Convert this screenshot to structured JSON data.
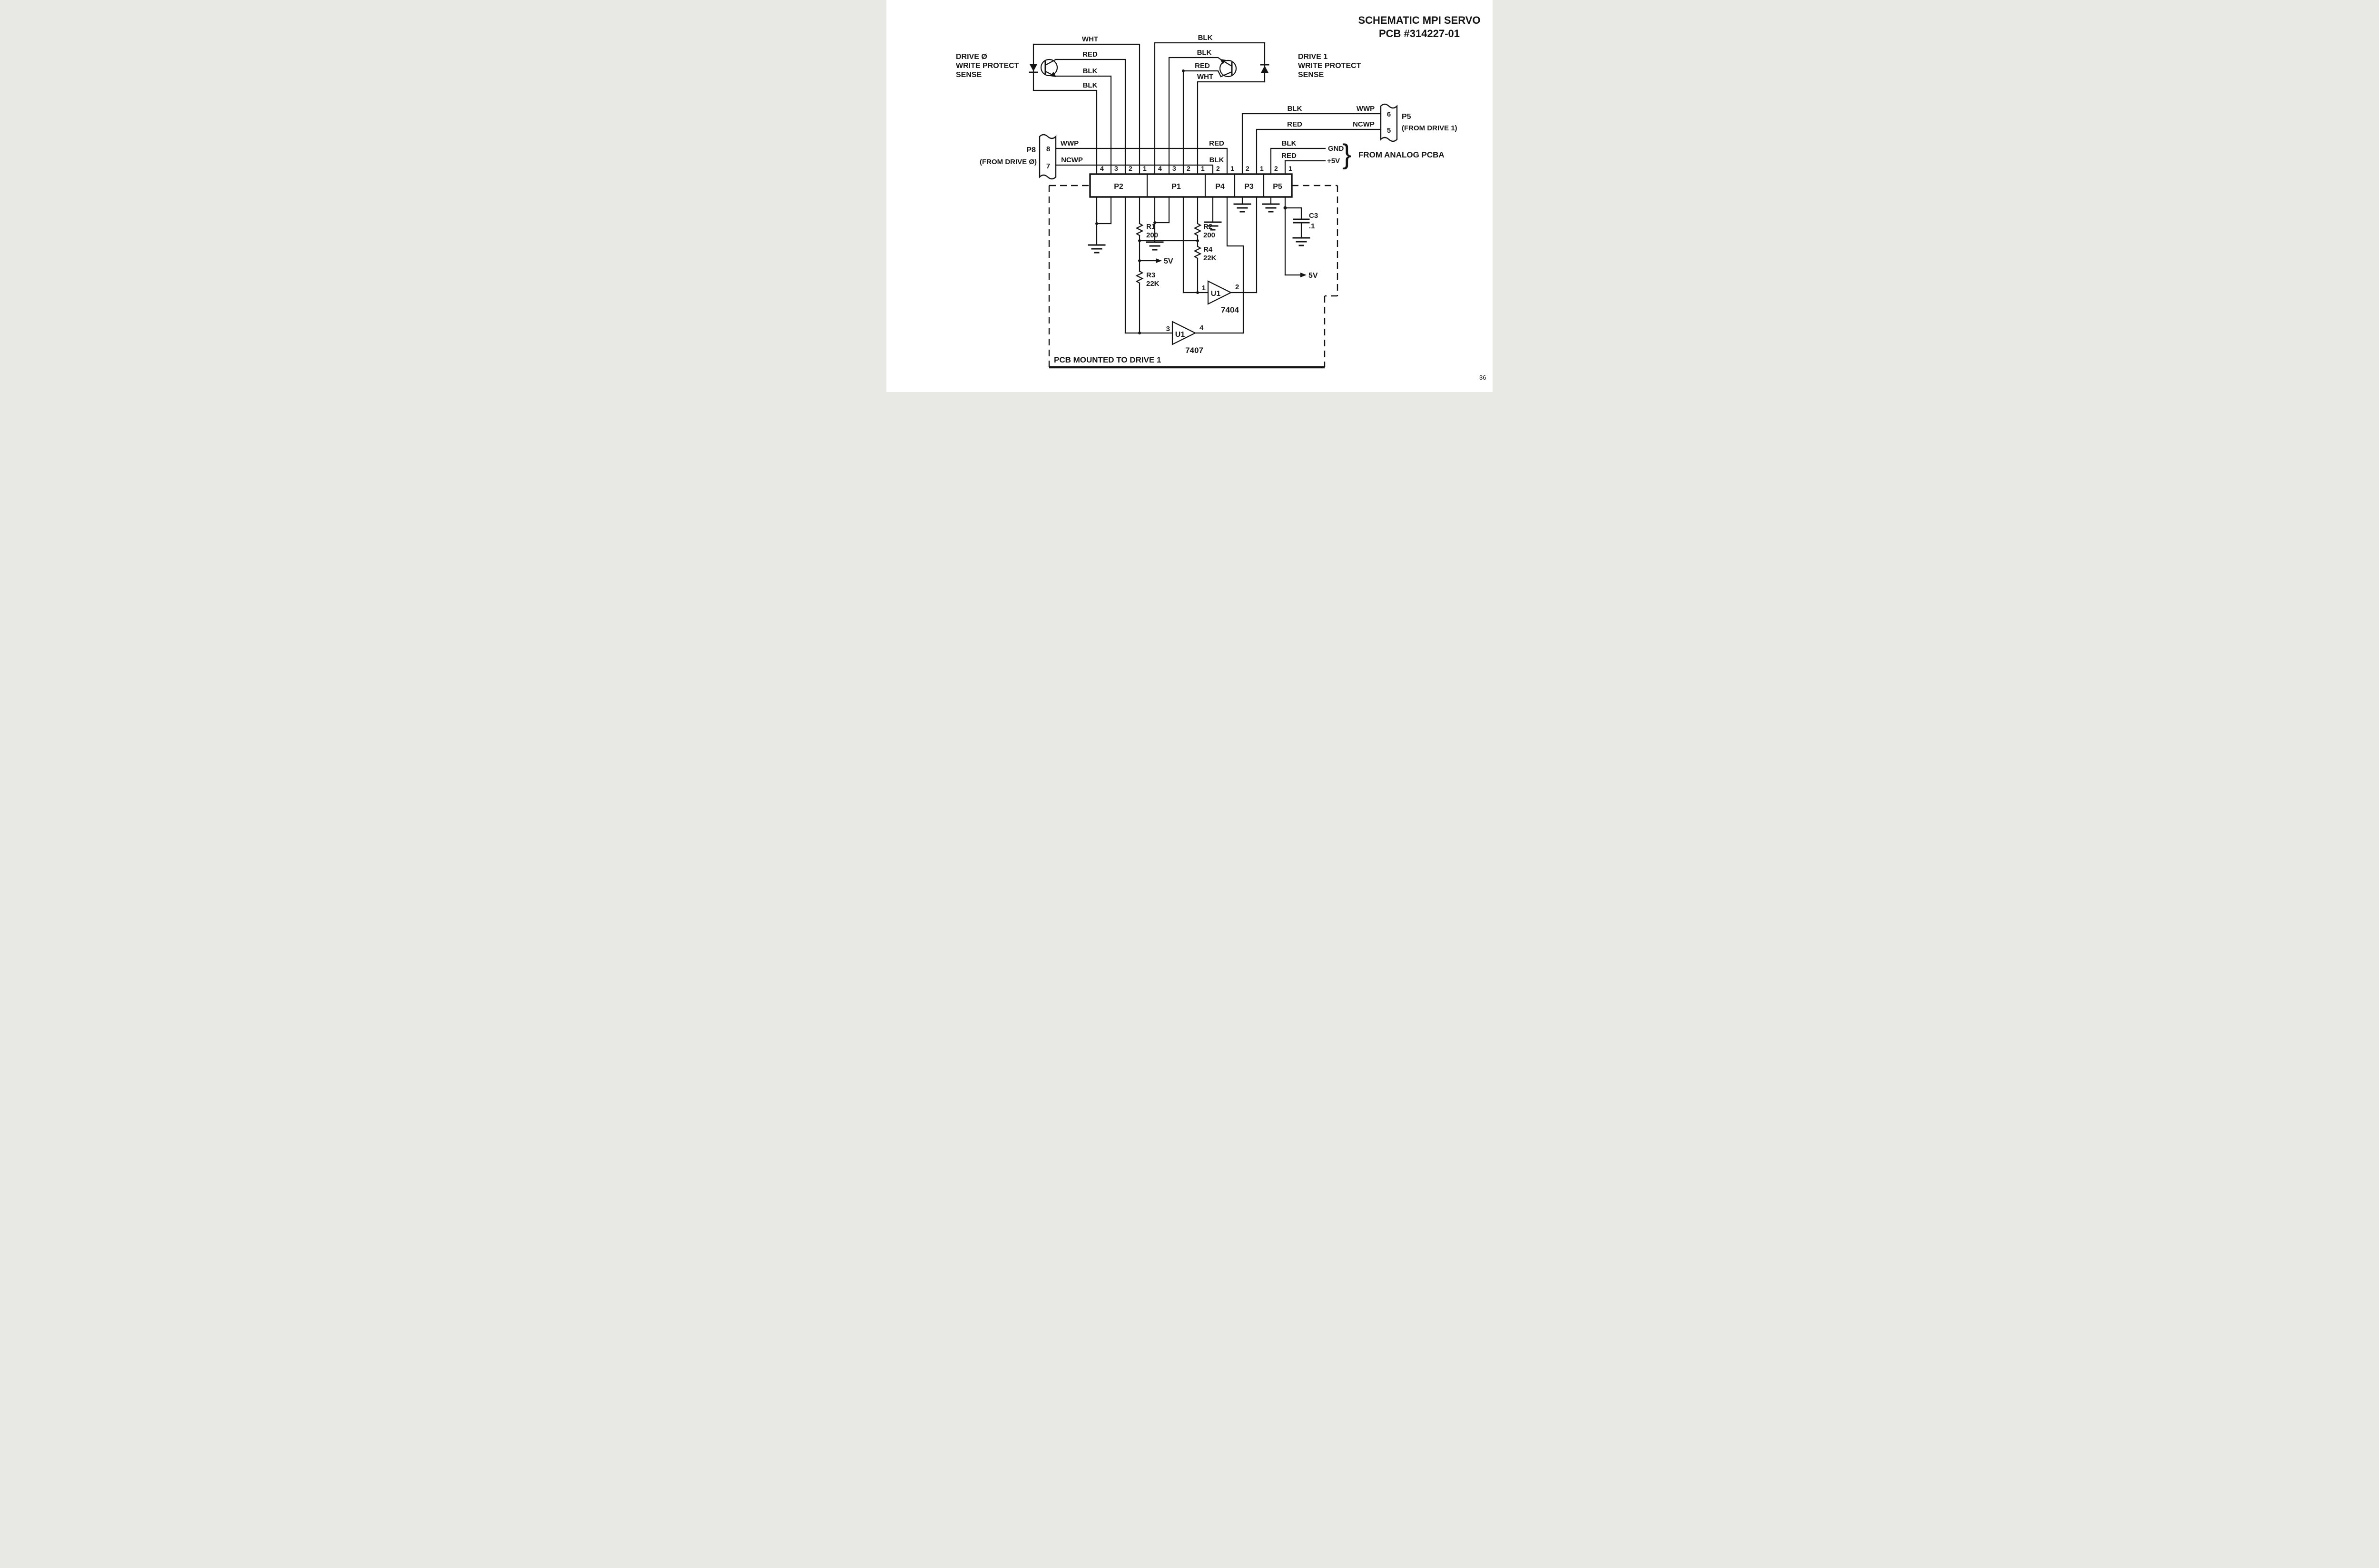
{
  "title": {
    "line1": "SCHEMATIC MPI SERVO",
    "line2": "PCB #314227-01"
  },
  "page_number": "36",
  "drive0": {
    "label1": "DRIVE Ø",
    "label2": "WRITE PROTECT",
    "label3": "SENSE",
    "wires": [
      "WHT",
      "RED",
      "BLK",
      "BLK"
    ]
  },
  "drive1": {
    "label1": "DRIVE 1",
    "label2": "WRITE PROTECT",
    "label3": "SENSE",
    "wires": [
      "BLK",
      "BLK",
      "RED",
      "WHT"
    ]
  },
  "p8": {
    "name": "P8",
    "from": "(FROM DRIVE Ø)",
    "pins": [
      {
        "num": "8",
        "signal": "WWP",
        "color": "RED"
      },
      {
        "num": "7",
        "signal": "NCWP",
        "color": "BLK"
      }
    ]
  },
  "p5_drive1": {
    "name": "P5",
    "from": "(FROM DRIVE 1)",
    "pins": [
      {
        "num": "6",
        "signal": "WWP",
        "color": "BLK"
      },
      {
        "num": "5",
        "signal": "NCWP",
        "color": "RED"
      }
    ]
  },
  "analog": {
    "label": "FROM ANALOG PCBA",
    "brace": "}",
    "rails": [
      {
        "color": "BLK",
        "name": "GND"
      },
      {
        "color": "RED",
        "name": "+5V"
      }
    ]
  },
  "strip": {
    "sections": [
      {
        "name": "P2",
        "pins": [
          "4",
          "3",
          "2",
          "1"
        ]
      },
      {
        "name": "P1",
        "pins": [
          "4",
          "3",
          "2",
          "1"
        ]
      },
      {
        "name": "P4",
        "pins": [
          "2",
          "1"
        ]
      },
      {
        "name": "P3",
        "pins": [
          "2",
          "1"
        ]
      },
      {
        "name": "P5",
        "pins": [
          "2",
          "1"
        ]
      }
    ]
  },
  "components": {
    "r1": {
      "ref": "R1",
      "value": "200"
    },
    "r2": {
      "ref": "R2",
      "value": "200"
    },
    "r3": {
      "ref": "R3",
      "value": "22K"
    },
    "r4": {
      "ref": "R4",
      "value": "22K"
    },
    "c3": {
      "ref": "C3",
      "value": ".1"
    },
    "u1a": {
      "ref": "U1",
      "part": "7404",
      "pin_in": "1",
      "pin_out": "2"
    },
    "u1b": {
      "ref": "U1",
      "part": "7407",
      "pin_in": "3",
      "pin_out": "4"
    }
  },
  "power": {
    "v5_mid": "5V",
    "v5_right": "5V"
  },
  "boundary": {
    "note": "PCB MOUNTED TO DRIVE 1"
  }
}
